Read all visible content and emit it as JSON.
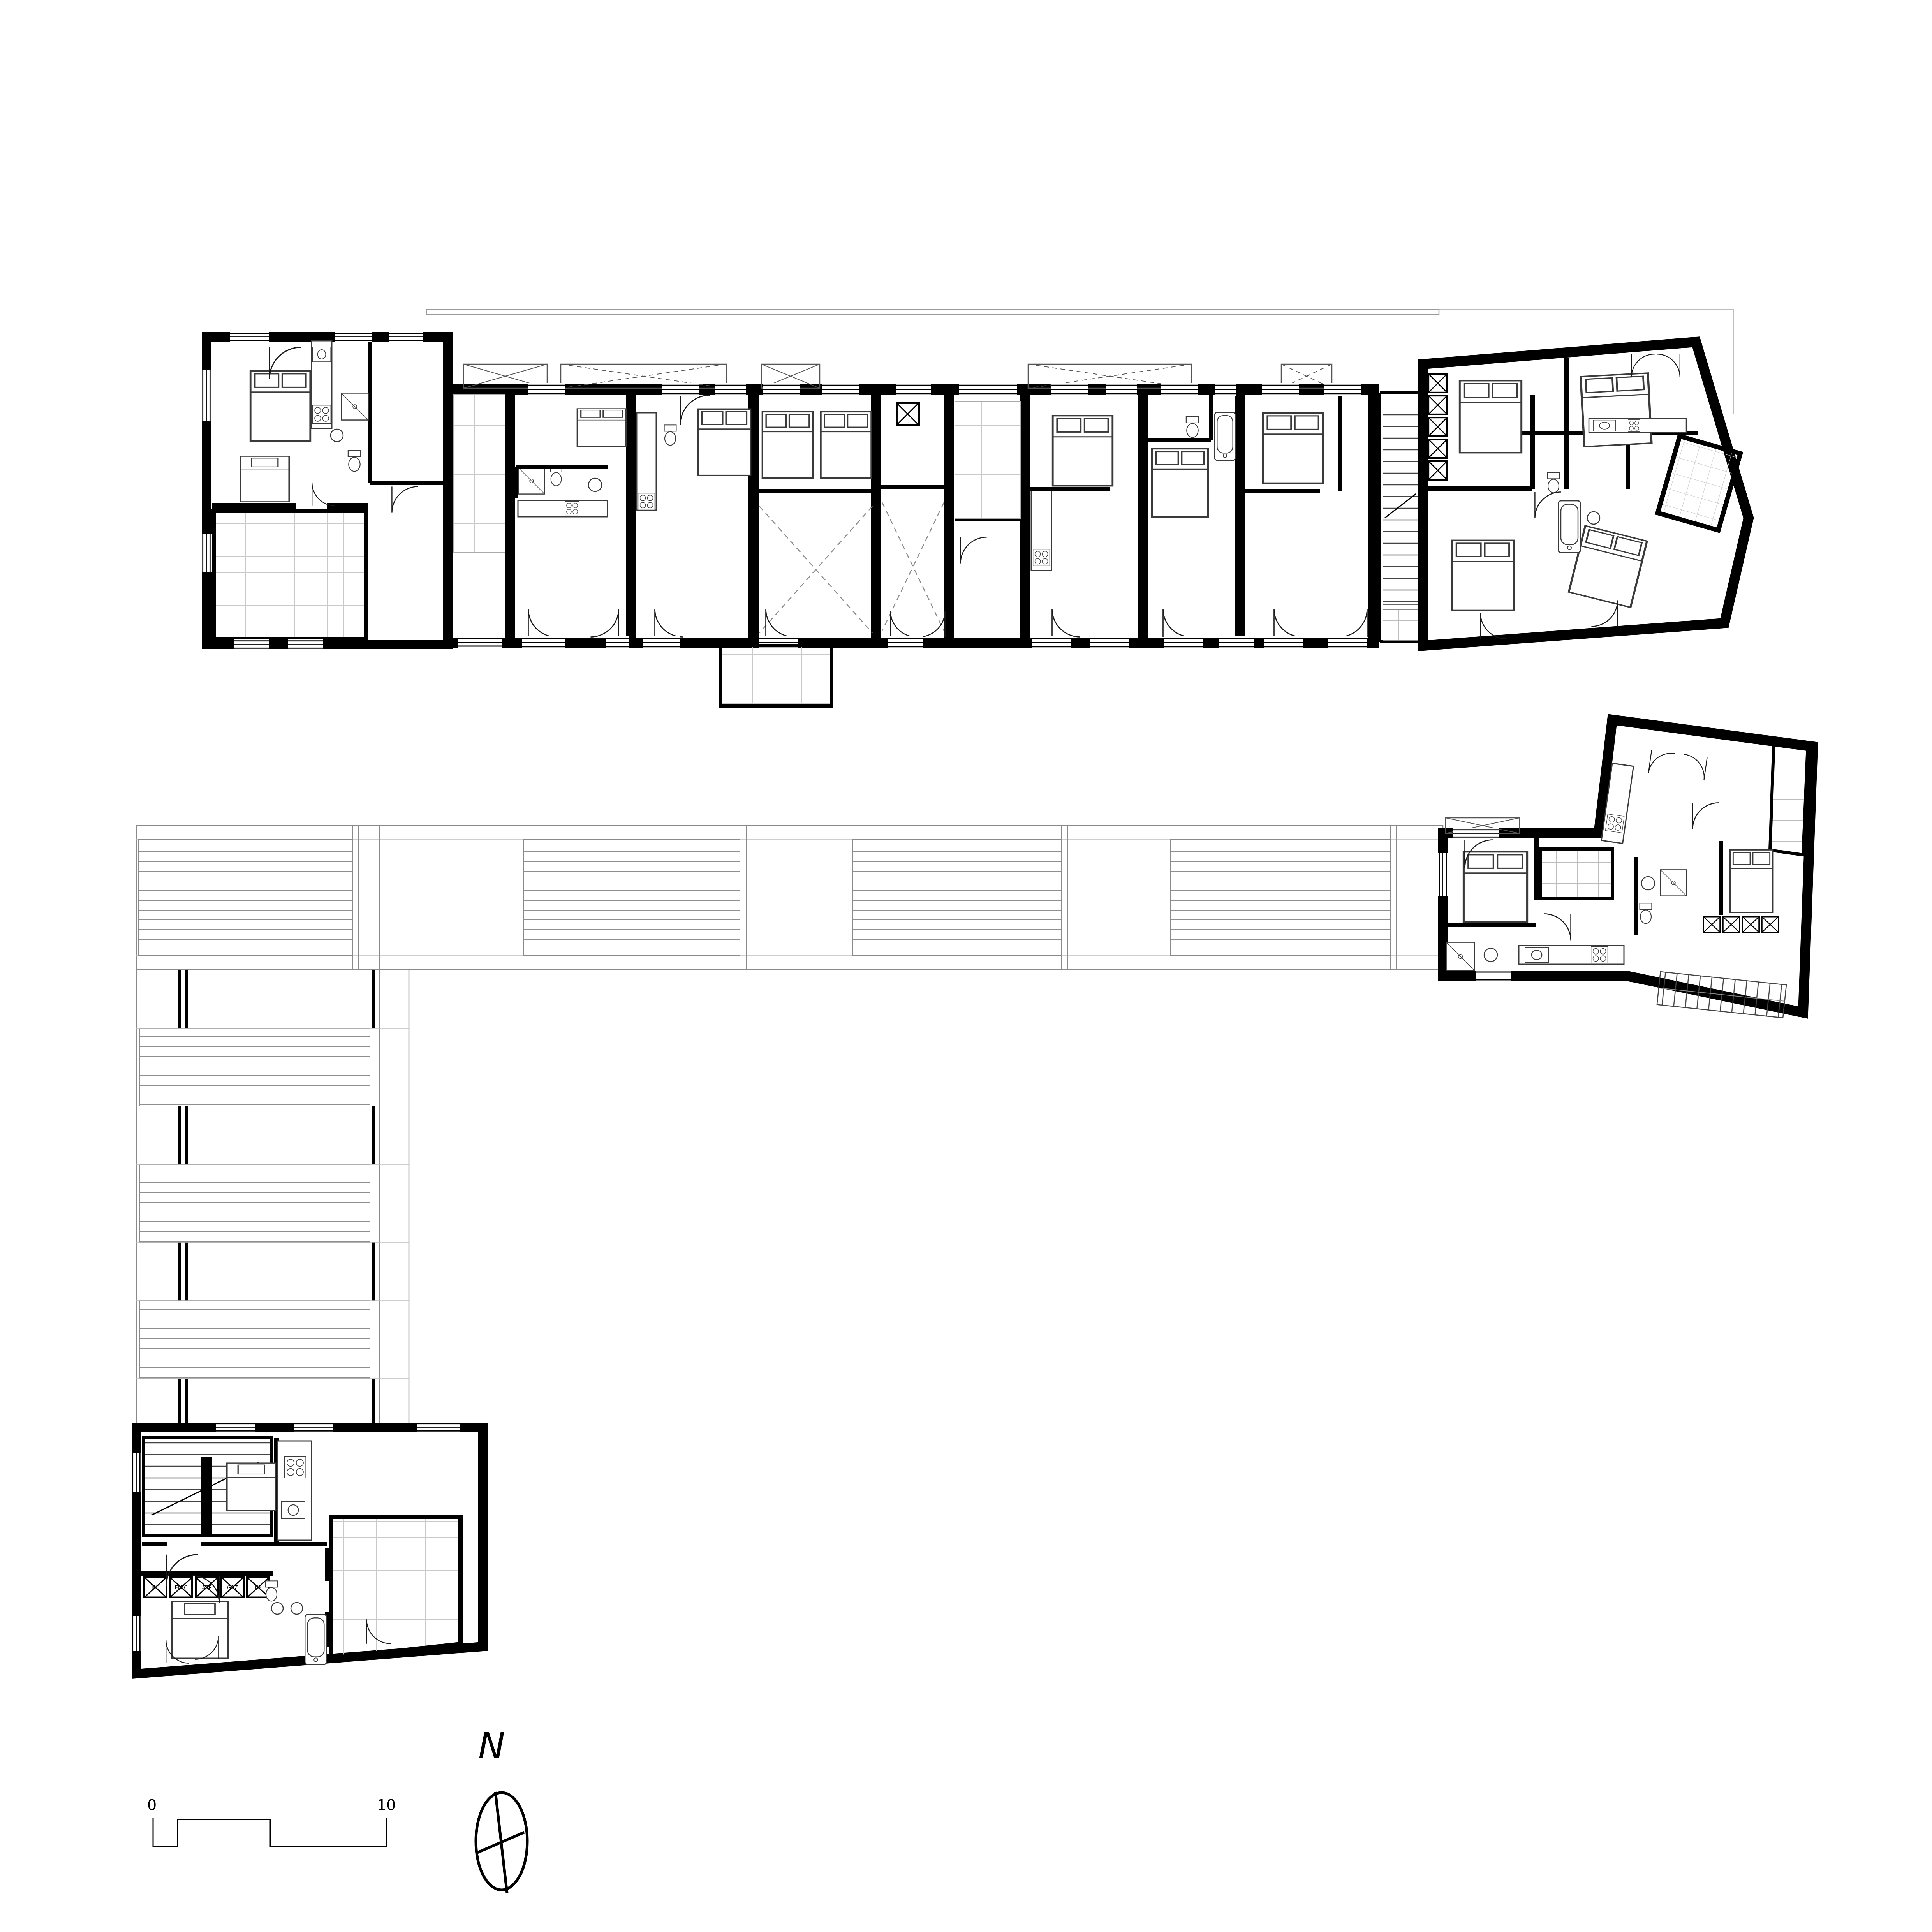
{
  "document": {
    "type": "architectural-floor-plan",
    "title": "Residential floor plan — apartment band with louvered walkways, terraces and stair cores",
    "background_color": "#ffffff",
    "ink_color": "#000000"
  },
  "scale_bar": {
    "start_label": "0",
    "end_label": "10"
  },
  "north_arrow": {
    "label": "N"
  },
  "technical_shafts": {
    "labels": [
      "EC",
      "ELEC",
      "ASP",
      "GAZ",
      "CF"
    ]
  },
  "areas": [
    {
      "id": "unit-a",
      "label": "corner apartment with gridded terrace",
      "position": "top-left"
    },
    {
      "id": "apartment-band",
      "label": "row of seven apartments with balconies and central open terrace",
      "position": "top"
    },
    {
      "id": "stair-core",
      "label": "shared stair core",
      "position": "top-right"
    },
    {
      "id": "unit-end",
      "label": "end apartment with splayed facade and tilted terrace",
      "position": "top-right"
    },
    {
      "id": "unit-detached",
      "label": "detached apartment with rotated wing and internal stair",
      "position": "middle-right"
    },
    {
      "id": "walkway-horizontal",
      "label": "louvered canopy band (horizontal)",
      "position": "middle"
    },
    {
      "id": "walkway-vertical",
      "label": "louvered canopy band (vertical)",
      "position": "left"
    },
    {
      "id": "unit-bottom",
      "label": "apartment with double stair flight and tiled terrace",
      "position": "bottom-left"
    }
  ],
  "colors": {
    "wall": "#000000",
    "furniture_line": "#3a3a3a",
    "thin_line": "#8a8a8a",
    "grid_line": "#c9c9c9",
    "louver_line": "#8f8f8f",
    "dash_line": "#8c8c8c"
  }
}
